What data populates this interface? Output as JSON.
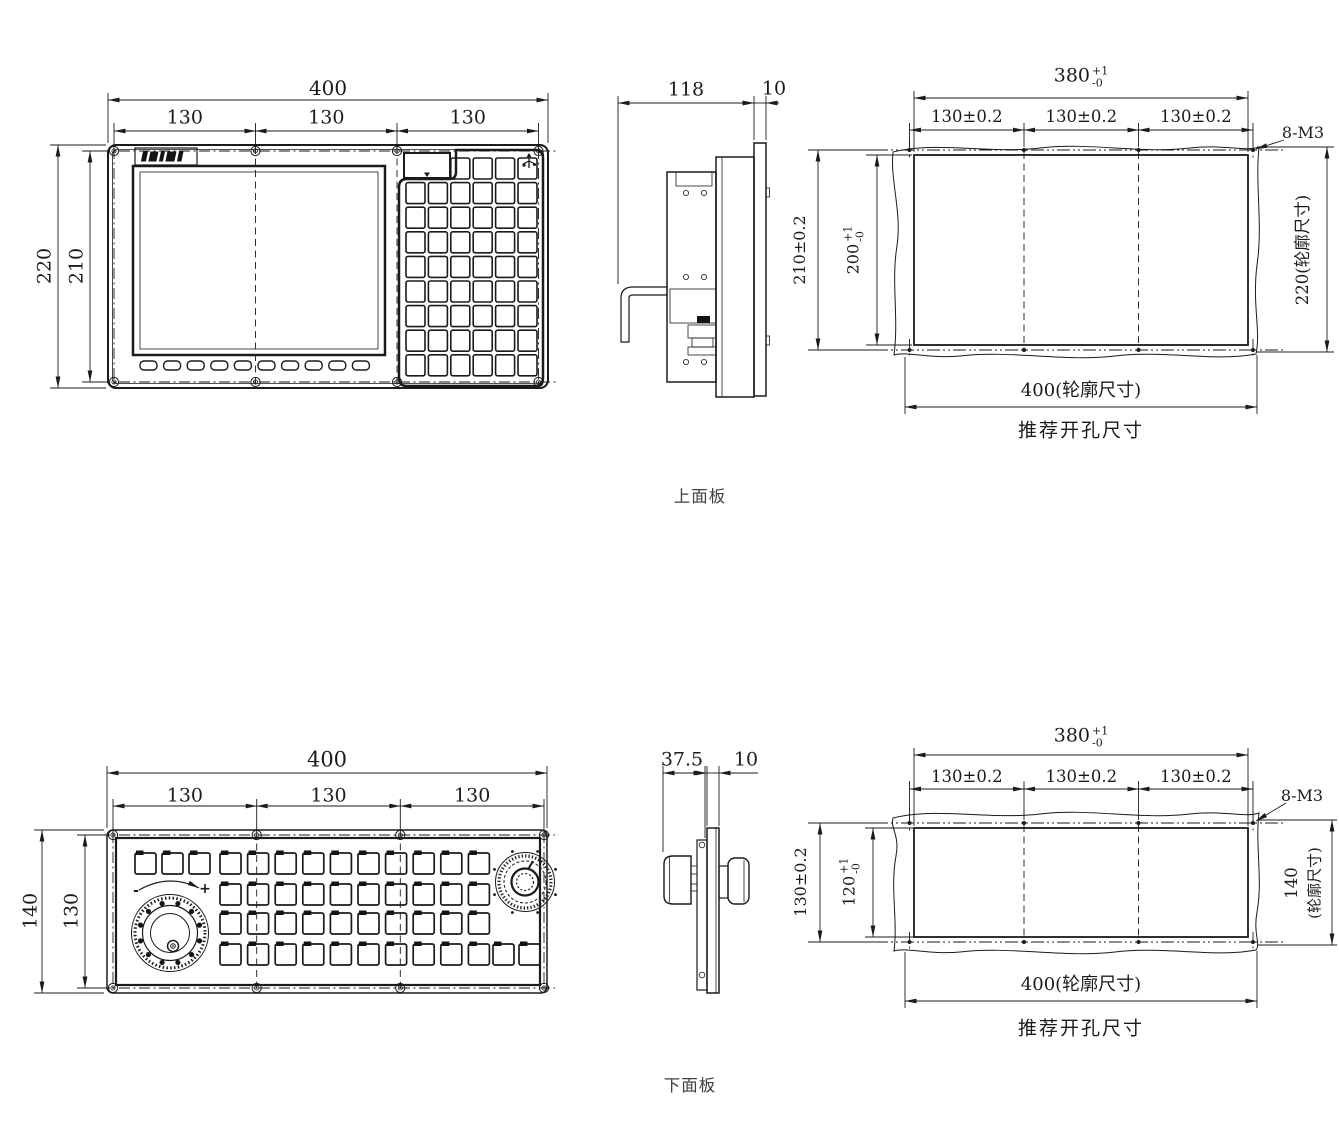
{
  "upper_panel": {
    "caption": "上面板",
    "front_view": {
      "dim_total_width": "400",
      "dim_width_segments": [
        "130",
        "130",
        "130"
      ],
      "dim_outer_height": "220",
      "dim_inner_height": "210"
    },
    "side_view": {
      "dim_depth": "118",
      "dim_thickness": "10"
    },
    "cutout": {
      "caption": "推荐开孔尺寸",
      "dim_cutout_width": {
        "value": "380",
        "tol_upper": "+1",
        "tol_lower": "-0"
      },
      "dim_hole_pitch": [
        "130±0.2",
        "130±0.2",
        "130±0.2"
      ],
      "dim_thread": "8-M3",
      "dim_hole_pitch_vertical": "210±0.2",
      "dim_cutout_height": {
        "value": "200",
        "tol_upper": "+1",
        "tol_lower": "-0"
      },
      "dim_outline_height": "220(轮廓尺寸)",
      "dim_outline_width": "400(轮廓尺寸)"
    }
  },
  "lower_panel": {
    "caption": "下面板",
    "front_view": {
      "dim_total_width": "400",
      "dim_width_segments": [
        "130",
        "130",
        "130"
      ],
      "dim_outer_height": "140",
      "dim_inner_height": "130",
      "handwheel_minus": "-",
      "handwheel_plus": "+"
    },
    "side_view": {
      "dim_depth": "37.5",
      "dim_thickness": "10"
    },
    "cutout": {
      "caption": "推荐开孔尺寸",
      "dim_cutout_width": {
        "value": "380",
        "tol_upper": "+1",
        "tol_lower": "-0"
      },
      "dim_hole_pitch": [
        "130±0.2",
        "130±0.2",
        "130±0.2"
      ],
      "dim_thread": "8-M3",
      "dim_hole_pitch_vertical": "130±0.2",
      "dim_cutout_height": {
        "value": "120",
        "tol_upper": "+1",
        "tol_lower": "-0"
      },
      "dim_outline_height_value": "140",
      "dim_outline_height_suffix": "(轮廓尺寸)",
      "dim_outline_width": "400(轮廓尺寸)"
    }
  }
}
